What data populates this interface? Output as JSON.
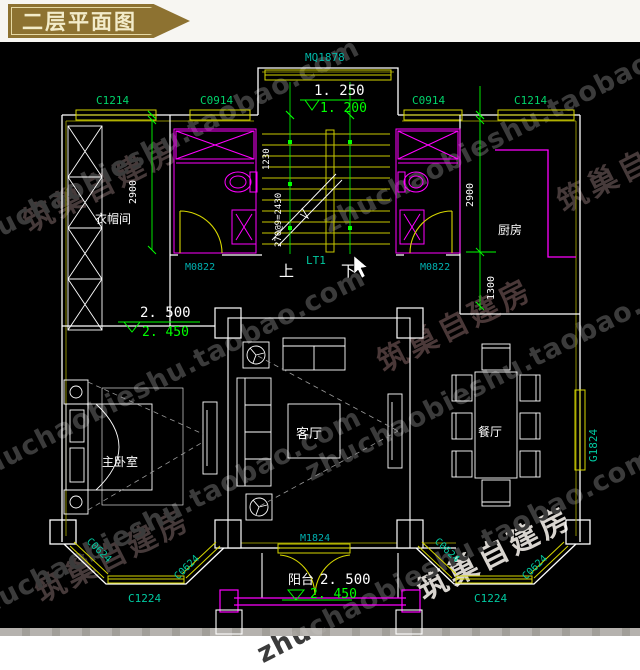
{
  "title": "二层平面图",
  "watermark": {
    "url": "zhuchaobieshu.taobao.com",
    "brand": "筑巢自建房"
  },
  "colors": {
    "background": "#000000",
    "wall": "#ffffff",
    "window": "#d6d600",
    "dimension": "#00ff00",
    "code_label": "#00c9a0",
    "fixture": "#ff00ff",
    "banner": "#8d7231",
    "banner_text": "#f3ecca"
  },
  "labels": {
    "mq1878": "MQ1878",
    "c1214_tl": "C1214",
    "c0914_tl": "C0914",
    "c0914_tr": "C0914",
    "c1214_tr": "C1214",
    "lvl_1250": "1. 250",
    "lvl_1200": "1. 200",
    "dim_1230": "1230",
    "stair_note": "270@9=2430",
    "lt1": "LT1",
    "up": "上",
    "down": "下",
    "m0822_l": "M0822",
    "m0822_r": "M0822",
    "dim_2900_l": "2900",
    "dim_2900_r": "2900",
    "dim_1300": "1300",
    "cloakroom": "衣帽间",
    "kitchen": "厨房",
    "master_bedroom": "主卧室",
    "living_room": "客厅",
    "dining_room": "餐厅",
    "balcony": "阳台",
    "lvl_2500_mid": "2. 500",
    "lvl_2450_mid": "2. 450",
    "lvl_2500_bal": "2. 500",
    "lvl_2450_bal": "2. 450",
    "g1824": "G1824",
    "m1824": "M1824",
    "c0624_l1": "C0624",
    "c0624_l2": "C0624",
    "c1224_l": "C1224",
    "c0624_r1": "C0624",
    "c0624_r2": "C0624",
    "c1224_r": "C1224"
  }
}
